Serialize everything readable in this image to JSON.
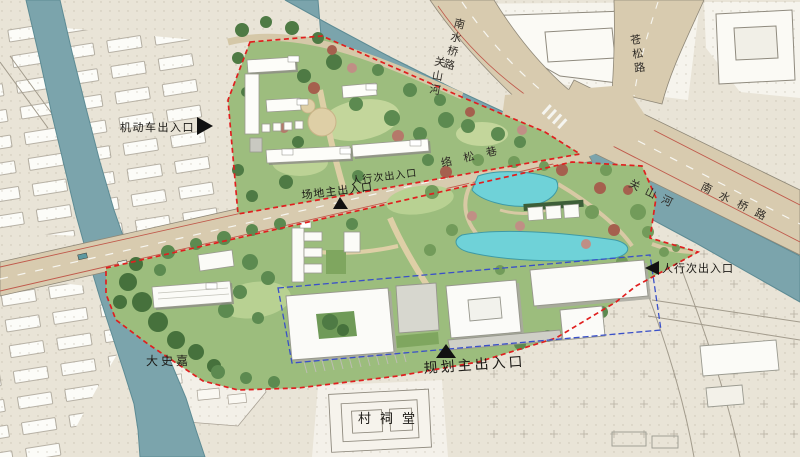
{
  "plan": {
    "labels": {
      "vehicle_entrance": "机动车出入口",
      "pedestrian_secondary_north": "人行次出入口",
      "site_main_entrance": "场地主出入口",
      "pedestrian_secondary_east": "人行次出入口",
      "planning_main_entrance": "规划主出入口"
    },
    "roads": {
      "nanshuiqiao_north": "南水桥路",
      "cangsong": "苍松路",
      "luosong_lane": "络松巷",
      "nanshuiqiao_east": "南水桥路"
    },
    "rivers": {
      "guanshan_north": "关山河",
      "guanshan_east": "关山河"
    },
    "places": {
      "dashijia": "大史嘉",
      "village_ancestral_hall": "村祠堂"
    },
    "colors": {
      "site_boundary_red": "#e01f1f",
      "building_parcel_blue": "#3a50c8",
      "river_water": "#7ba4ac",
      "pond_water": "#6fd2d8",
      "road_surface": "#d8cbaf",
      "site_green": "#9cbd7d",
      "background": "#e9e4d7"
    }
  }
}
